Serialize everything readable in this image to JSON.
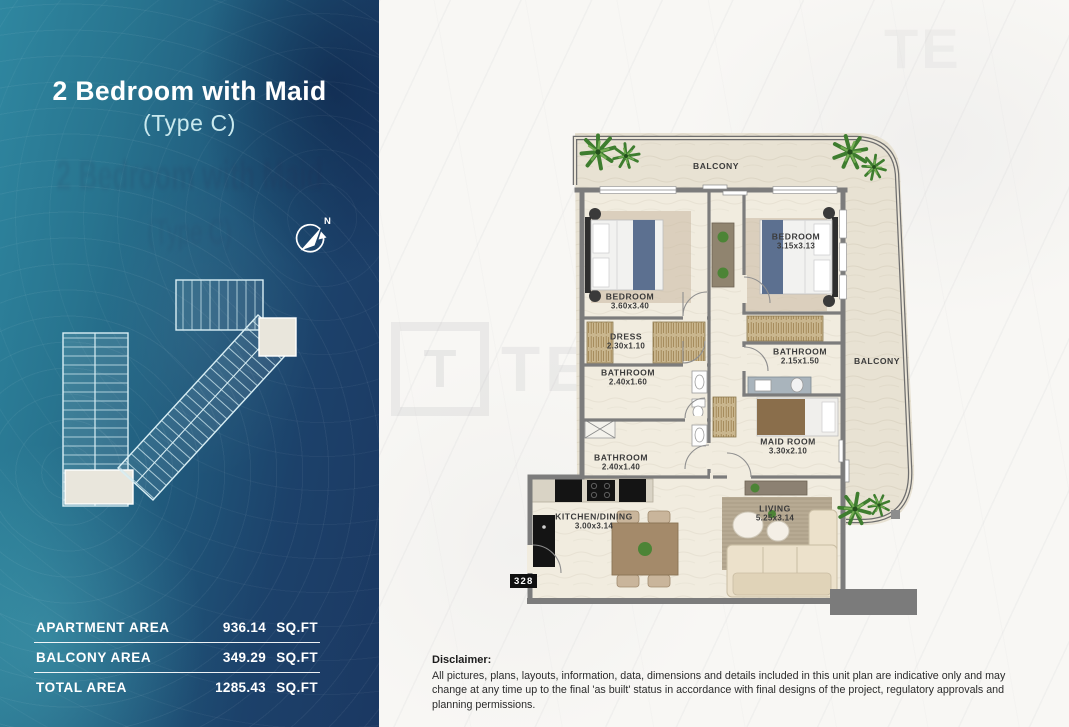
{
  "panel": {
    "title": "2 Bedroom with Maid",
    "subtitle": "(Type C)",
    "compass": "N",
    "stats": [
      {
        "label": "APARTMENT AREA",
        "value": "936.14",
        "unit": "SQ.FT"
      },
      {
        "label": "BALCONY AREA",
        "value": "349.29",
        "unit": "SQ.FT"
      },
      {
        "label": "TOTAL AREA",
        "value": "1285.43",
        "unit": "SQ.FT"
      }
    ]
  },
  "floorplan": {
    "unit_number": "328",
    "rooms": {
      "balcony_top": {
        "name": "BALCONY",
        "dim": ""
      },
      "bedroom_left": {
        "name": "BEDROOM",
        "dim": "3.60x3.40"
      },
      "bedroom_right": {
        "name": "BEDROOM",
        "dim": "3.15x3.13"
      },
      "dress": {
        "name": "DRESS",
        "dim": "2.30x1.10"
      },
      "bathroom_left_upper": {
        "name": "BATHROOM",
        "dim": "2.40x1.60"
      },
      "bathroom_right": {
        "name": "BATHROOM",
        "dim": "2.15x1.50"
      },
      "bathroom_left_lower": {
        "name": "BATHROOM",
        "dim": "2.40x1.40"
      },
      "maid_room": {
        "name": "MAID ROOM",
        "dim": "3.30x2.10"
      },
      "kitchen_dining": {
        "name": "KITCHEN/DINING",
        "dim": "3.00x3.14"
      },
      "living": {
        "name": "LIVING",
        "dim": "5.25x3.14"
      },
      "balcony_right": {
        "name": "BALCONY",
        "dim": ""
      }
    }
  },
  "watermark": {
    "logo_letter": "T",
    "brand": "TEKCE",
    "corner": "TE"
  },
  "disclaimer": {
    "title": "Disclaimer:",
    "text": "All pictures, plans, layouts, information, data, dimensions and details included in this unit plan are indicative only and may change at any time up to the final 'as built' status in accordance with final designs of the project, regulatory approvals and planning permissions."
  },
  "colors": {
    "panel_teal": "#2f87a0",
    "panel_navy": "#1b3862",
    "accent_light": "#c9e9ee",
    "wall_gray": "#7c7c7c",
    "floor_cream": "#ece7db",
    "highlight_beige": "#e8e5da"
  }
}
